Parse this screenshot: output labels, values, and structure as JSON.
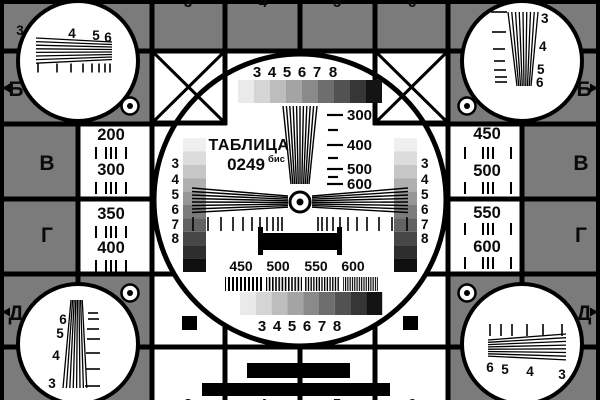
{
  "colors": {
    "background": "#7b7b7b",
    "ink": "#000000",
    "white": "#ffffff"
  },
  "title": {
    "word": "ТАБЛИЦА",
    "number": "0249",
    "suffix": "бис"
  },
  "row_labels": {
    "left": [
      "Б",
      "В",
      "Г",
      "Д"
    ],
    "right": [
      "Б",
      "В",
      "Г",
      "Д"
    ]
  },
  "frequency_cells": {
    "left": [
      "200",
      "300",
      "350",
      "400"
    ],
    "right": [
      "450",
      "500",
      "550",
      "600"
    ]
  },
  "corner_numbers": {
    "top_left": [
      "3",
      "4",
      "5",
      "6"
    ],
    "top_right": [
      "3",
      "4",
      "5",
      "6"
    ],
    "bottom_left": [
      "6",
      "5",
      "4",
      "3"
    ],
    "bottom_right": [
      "6",
      "5",
      "4",
      "3"
    ]
  },
  "grade_numbers": [
    "3",
    "4",
    "5",
    "6",
    "7",
    "8"
  ],
  "wedge_scale_labels": [
    "300",
    "400",
    "500",
    "600"
  ],
  "burst_labels": [
    "450",
    "500",
    "550",
    "600"
  ],
  "edge_column_digits": [
    "3",
    "4",
    "5",
    "6"
  ],
  "grayscale_bar_steps": [
    "#eaeaea",
    "#d5d5d5",
    "#bdbdbd",
    "#a4a4a4",
    "#8a8a8a",
    "#6e6e6e",
    "#525252",
    "#363636",
    "#141414"
  ],
  "grayscale_strip_steps": [
    "#efefef",
    "#dcdcdc",
    "#c6c6c6",
    "#afafaf",
    "#969696",
    "#7c7c7c",
    "#626262",
    "#474747",
    "#2d2d2d",
    "#0f0f0f"
  ]
}
